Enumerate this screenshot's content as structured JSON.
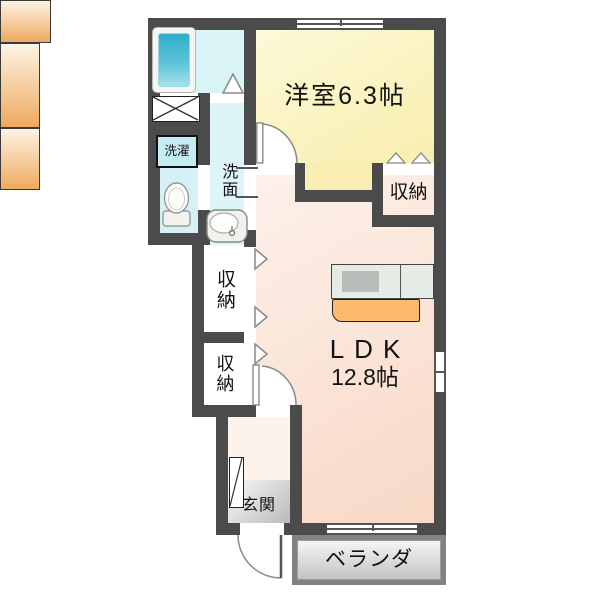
{
  "plan": {
    "type": "apartment-floorplan",
    "rooms": {
      "western": {
        "label": "洋室6.3帖"
      },
      "ldk": {
        "label": "LDK",
        "size": "12.8帖"
      },
      "closet_right": {
        "label": "収納"
      },
      "closet_upper": {
        "label": "収納"
      },
      "closet_lower": {
        "label": "収納"
      },
      "laundry": {
        "label": "洗濯"
      },
      "washroom": {
        "label": "洗面"
      },
      "entrance": {
        "label": "玄関"
      },
      "veranda": {
        "label": "ベランダ"
      }
    },
    "fixtures": [
      "bathtub",
      "crossed-box",
      "washing-machine-space",
      "toilet",
      "washbasin",
      "kitchen-counter",
      "stove",
      "shoe-cabinet"
    ],
    "colors": {
      "wall": "#4b4b4b",
      "western_room_floor": "#f9f0b8",
      "ldk_floor": "#fae2d2",
      "wet_area_floor": "#d9f3f7",
      "closet_top": "#fdf4e4",
      "closet_bottom": "#efa95f",
      "kitchen_counter": "#e5ebe5",
      "counter_orange": "#fbba6e",
      "entrance_floor": "#c9c9c9",
      "veranda_frame": "#828282",
      "bathtub": "#2fadc9"
    }
  }
}
